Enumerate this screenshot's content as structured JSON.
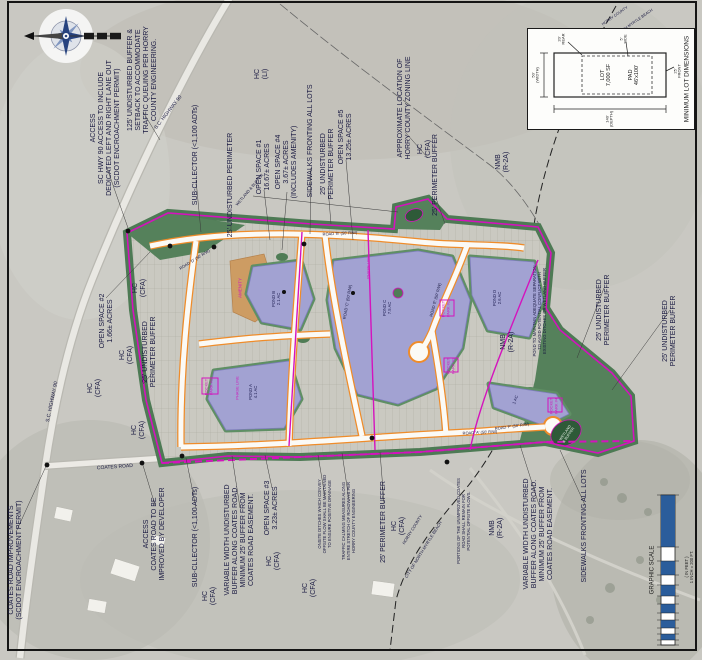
{
  "colors": {
    "boundary_magenta": "#d413bd",
    "road_orange": "#ef8c2a",
    "pond_lavender": "#a2a2d2",
    "buffer_green": "#4d7a54",
    "open_space_green": "#55815b",
    "amenity_tan": "#cd9c63",
    "annotation_ink": "#181840",
    "scale_blue": "#2b5d9b"
  },
  "lot_box": {
    "title": "MINIMUM LOT DIMENSIONS",
    "lot": "LOT\n7,000 SF",
    "pad": "PAD\n46'x100'",
    "rear": "20'\nREAR",
    "side": "5'\nSIDE",
    "front": "25'\nFRONT",
    "width": "50'\n(WIDTH)",
    "depth": "140'\n(DEPTH)"
  },
  "scale_bar": {
    "label": "GRAPHIC SCALE",
    "units": "( IN FEET )\n1 INCH = 200 FT."
  },
  "labels": [
    {
      "name": "access-hwy90-note",
      "text": "ACCESS\nSC HWY 90 ACCESS TO INCLUDE\nDEDICATED LEFT AND RIGHT LANE OUT\n(SCDOT ENCROACHMENT PERMIT)",
      "x": 106,
      "y": 128
    },
    {
      "name": "queuing-buffer-note",
      "text": "125' UNDISTURBED BUFFER &\nSETBACK TO ACCOMMODATE\nTRAFFIC QUEUING PER HORRY\nCOUNTY ENGINEERING.",
      "x": 143,
      "y": 80
    },
    {
      "name": "hwy90-road-label",
      "text": "S.C. HIGHWAY 90",
      "x": 169,
      "y": 113,
      "rot": -52,
      "size": 5
    },
    {
      "name": "hwy90-road-label-south",
      "text": "S.C. HIGHWAY 90",
      "x": 53,
      "y": 402,
      "rot": -78,
      "size": 5
    },
    {
      "name": "subcollector-note-north",
      "text": "SUB-CLLECTOR (<1,100 ADTs)",
      "x": 196,
      "y": 155
    },
    {
      "name": "undisturbed-perimeter-note-north",
      "text": "25' UNDISTURBED PERIMETER",
      "x": 231,
      "y": 185
    },
    {
      "name": "zoning-hc-li",
      "text": "HC\n(LI)",
      "x": 262,
      "y": 74
    },
    {
      "name": "open-space-1-label",
      "text": "OPEN SPACE #1\n16.67± ACRES",
      "x": 264,
      "y": 167
    },
    {
      "name": "open-space-4-label",
      "text": "OPEN SPACE #4\n3.67± ACRES\n(INCLUDES AMENITY)",
      "x": 287,
      "y": 162
    },
    {
      "name": "sidewalks-note-north",
      "text": "SIDEWALKS FRONTING ALL LOTS",
      "x": 311,
      "y": 141
    },
    {
      "name": "undisturbed-buffer-note-north",
      "text": "25' UNDISTURBED\nPERIMETER BUFFER",
      "x": 328,
      "y": 164
    },
    {
      "name": "open-space-5-label",
      "text": "OPEN SPACE #5\n13.25± ACRES",
      "x": 346,
      "y": 137
    },
    {
      "name": "wetland-buffer-callout",
      "text": "WETLAND & BUFFER",
      "x": 250,
      "y": 190,
      "rot": -50,
      "size": 4
    },
    {
      "name": "zoning-line-note",
      "text": "APPROXIMATE LOCATION OF\nHORRY COUNTY ZONING LINE",
      "x": 405,
      "y": 108
    },
    {
      "name": "zoning-hc-cfa-1",
      "text": "HC\n(CFA)",
      "x": 425,
      "y": 149
    },
    {
      "name": "zoning-nmb-north",
      "text": "NMB\n(R-2A)",
      "x": 503,
      "y": 162
    },
    {
      "name": "perimeter-buffer-note-ne",
      "text": "25' PERIMETER BUFFER",
      "x": 436,
      "y": 175
    },
    {
      "name": "open-space-2-label",
      "text": "OPEN SPACE #2\n1.66± ACRES",
      "x": 107,
      "y": 321
    },
    {
      "name": "zoning-hc-cfa-2",
      "text": "HC\n(CFA)",
      "x": 140,
      "y": 288
    },
    {
      "name": "zoning-hc-cfa-3",
      "text": "HC\n(CFA)",
      "x": 127,
      "y": 355
    },
    {
      "name": "zoning-hc-cfa-4",
      "text": "HC\n(CFA)",
      "x": 95,
      "y": 388
    },
    {
      "name": "zoning-hc-cfa-5",
      "text": "HC\n(CFA)",
      "x": 139,
      "y": 430
    },
    {
      "name": "undisturbed-buffer-note-west",
      "text": "25' UNDISTURBED\nPERIMETER BUFFER",
      "x": 150,
      "y": 352
    },
    {
      "name": "coates-improvements-note",
      "text": "COATES ROAD IMPROVEMENTS\n(SCDOT ENCROACHMENT PERMIT)",
      "x": 16,
      "y": 560
    },
    {
      "name": "coates-road-label",
      "text": "COATES ROAD",
      "x": 115,
      "y": 468,
      "rot": -4,
      "size": 5
    },
    {
      "name": "access-coates-note",
      "text": "ACCESS\nCOATES ROAD TO BE\nIMPROVED BY DEVELOPER",
      "x": 155,
      "y": 534
    },
    {
      "name": "subcollector-note-south",
      "text": "SUB-CLLECTOR (<1,100 ADTs)",
      "x": 196,
      "y": 537
    },
    {
      "name": "zoning-hc-cfa-6",
      "text": "HC\n(CFA)",
      "x": 210,
      "y": 596
    },
    {
      "name": "variable-buffer-note-west",
      "text": "VARIABLE WIDTH UNDISTURBED\nBUFFER ALONG COATES ROAD.\nMINIMUM 25' BUFFER FROM\nCOATES ROAD EASEMENT.",
      "x": 240,
      "y": 540
    },
    {
      "name": "open-space-3-label",
      "text": "OPEN SPACE #3\n3.23± ACRES",
      "x": 272,
      "y": 508
    },
    {
      "name": "zoning-hc-cfa-7",
      "text": "HC\n(CFA)",
      "x": 274,
      "y": 561
    },
    {
      "name": "zoning-hc-cfa-8",
      "text": "HC\n(CFA)",
      "x": 310,
      "y": 588
    },
    {
      "name": "ditch-maintenance-note",
      "text": "ONSITE DITCHES WHICH CONVEY\nOFFSITE FLOW SHALL BE MAINTAINED\nTO ENSURE POSITIVE DRAINAGE",
      "x": 325,
      "y": 514,
      "size": 4.2
    },
    {
      "name": "traffic-calming-note",
      "text": "TRAFFIC CALMING MEASURES ALONG\nENTIRE STRETCH OF ROADWAYS PER\nHORRY COUNTY ENGINEERING",
      "x": 349,
      "y": 521,
      "size": 4.2
    },
    {
      "name": "perimeter-buffer-note-south",
      "text": "25' PERIMETER BUFFER",
      "x": 384,
      "y": 522
    },
    {
      "name": "zoning-hc-cfa-9",
      "text": "HC\n(CFA)",
      "x": 399,
      "y": 526
    },
    {
      "name": "county-line-label-horry",
      "text": "HORRY COUNTY",
      "x": 413,
      "y": 530,
      "rot": -58,
      "size": 4.2
    },
    {
      "name": "county-line-label-nmb",
      "text": "CITY OF NORTH MYRTLE BEACH",
      "x": 424,
      "y": 550,
      "rot": -58,
      "size": 4.2
    },
    {
      "name": "coates-unimproved-note",
      "text": "PORTIONS OF THE UNIMPROVED COATES\nROAD SHALL REMAIN FOR\nPOTENTIAL OFFSITE FLOWS.",
      "x": 464,
      "y": 521,
      "size": 4.2
    },
    {
      "name": "zoning-nmb-south",
      "text": "NMB\n(R-2A)",
      "x": 497,
      "y": 528
    },
    {
      "name": "variable-buffer-note-east",
      "text": "VARIABLE WIDTH UNDISTURBED\nBUFFER ALONG COATES ROAD.\nMINIMUM 25' BUFFER FROM\nCOATES ROAD EASEMENT.",
      "x": 539,
      "y": 534
    },
    {
      "name": "sidewalks-note-south",
      "text": "SIDEWALKS FRONTING ALL LOTS",
      "x": 585,
      "y": 526
    },
    {
      "name": "zoning-nmb-east",
      "text": "NMB\n(R-2A)",
      "x": 508,
      "y": 342
    },
    {
      "name": "pond-separation-note",
      "text": "POND TO MAINTAIN ADEQUATE SEPARATION\nTO AVOID POTENTIAL CONFLICT WITH\nEXISTING DITCHES OR WETLAND BUFFER",
      "x": 540,
      "y": 311,
      "size": 4.2
    },
    {
      "name": "undisturbed-buffer-note-east-1",
      "text": "25' UNDISTURBED\nPERIMETER BUFFER",
      "x": 604,
      "y": 310
    },
    {
      "name": "undisturbed-buffer-note-east-2",
      "text": "25' UNDISTURBED\nPERIMETER BUFFER",
      "x": 670,
      "y": 331
    },
    {
      "name": "county-line-label-horry-ne",
      "text": "HORRY COUNTY",
      "x": 615,
      "y": 16,
      "rot": -35,
      "size": 3.8
    },
    {
      "name": "county-line-label-nmb-ne",
      "text": "CITY OF NORTH MYRTLE BEACH",
      "x": 628,
      "y": 27,
      "rot": -35,
      "size": 3.8
    },
    {
      "name": "amenity-parcel-label",
      "text": "AMENITY",
      "x": 240,
      "y": 288,
      "size": 4.5,
      "color": "#cf17bb"
    },
    {
      "name": "pond-b-label",
      "text": "POND B\n2.1 AC",
      "x": 277,
      "y": 299,
      "size": 4.2,
      "color": "#1c1c50"
    },
    {
      "name": "phase-line-label-1",
      "text": "PHASE LINE",
      "x": 369,
      "y": 267,
      "size": 4,
      "color": "#cf17bb"
    },
    {
      "name": "phase-line-label-2",
      "text": "PHASE LINE",
      "x": 238,
      "y": 388,
      "size": 4,
      "color": "#cf17bb"
    },
    {
      "name": "pond-a-label",
      "text": "POND A\n4.1 AC",
      "x": 254,
      "y": 392,
      "size": 4.2,
      "color": "#1c1c50"
    },
    {
      "name": "pond-c-label",
      "text": "POND C\n7.5 AC",
      "x": 388,
      "y": 308,
      "size": 4.2,
      "color": "#1c1c50"
    },
    {
      "name": "pond-d-label",
      "text": "POND D\n2.6 AC",
      "x": 498,
      "y": 298,
      "size": 4.2,
      "color": "#1c1c50"
    },
    {
      "name": "pond-e-label",
      "text": "1 AC",
      "x": 516,
      "y": 400,
      "rot": -70,
      "size": 4.2,
      "color": "#1c1c50"
    },
    {
      "name": "pocket-park-label-1",
      "text": "POCKET\nPARK #1",
      "x": 209,
      "y": 387,
      "size": 4,
      "color": "#cf17bb"
    },
    {
      "name": "pocket-park-label-2",
      "text": "POCKET\nPARK #2",
      "x": 446,
      "y": 309,
      "size": 4,
      "color": "#cf17bb"
    },
    {
      "name": "pocket-park-label-3",
      "text": "POCKET\nPARK #3",
      "x": 451,
      "y": 366,
      "size": 4,
      "color": "#cf17bb"
    },
    {
      "name": "pocket-park-label-4",
      "text": "POCKET\nPARK #4",
      "x": 554,
      "y": 406,
      "size": 4,
      "color": "#cf17bb"
    },
    {
      "name": "wetland-se-label",
      "text": "WETLAND\n& BUFFER",
      "x": 567,
      "y": 434,
      "rot": -55,
      "size": 3.6,
      "color": "#eaf2ea"
    },
    {
      "name": "road-a-label",
      "text": "ROAD 'A' (50' R/W)",
      "x": 480,
      "y": 433,
      "rot": -3,
      "size": 4
    },
    {
      "name": "road-b-label",
      "text": "ROAD 'B' (50' R/W)",
      "x": 340,
      "y": 234,
      "rot": -3,
      "size": 4
    },
    {
      "name": "road-c-label",
      "text": "ROAD 'C' (50' R/W)",
      "x": 348,
      "y": 302,
      "rot": -80,
      "size": 4
    },
    {
      "name": "road-d-label",
      "text": "ROAD 'D' (50' R/W)",
      "x": 195,
      "y": 260,
      "rot": -32,
      "size": 4
    },
    {
      "name": "road-e-label",
      "text": "ROAD 'E' (50' R/W)",
      "x": 436,
      "y": 300,
      "rot": -75,
      "size": 4
    },
    {
      "name": "road-f-label",
      "text": "ROAD 'F' (50' R/W)",
      "x": 512,
      "y": 427,
      "rot": -8,
      "size": 4
    }
  ]
}
